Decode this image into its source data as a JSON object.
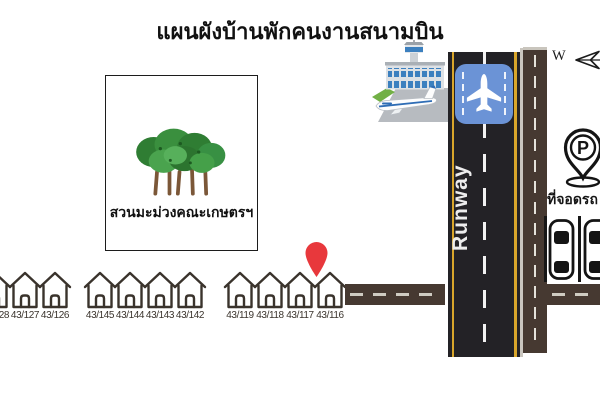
{
  "title": "แผนผังบ้านพักคนงานสนามบิน",
  "orchard": {
    "label": "สวนมะม่วงคณะเกษตรฯ"
  },
  "runway": {
    "label": "Runway"
  },
  "compass": {
    "west_label": "W"
  },
  "parking": {
    "label": "ที่จอดรถ",
    "pin_letter": "P"
  },
  "houses": [
    "43/128",
    "43/127",
    "43/126",
    "43/145",
    "43/144",
    "43/143",
    "43/142",
    "43/119",
    "43/118",
    "43/117",
    "43/116"
  ],
  "colors": {
    "road_brown": "#463931",
    "runway_black": "#232226",
    "runway_yellow_line": "#d9a62b",
    "runway_sign_blue": "#6b93d6",
    "location_pin_red": "#e8383c",
    "house_outline": "#3a332c",
    "tree_green": "#2f7d33"
  }
}
